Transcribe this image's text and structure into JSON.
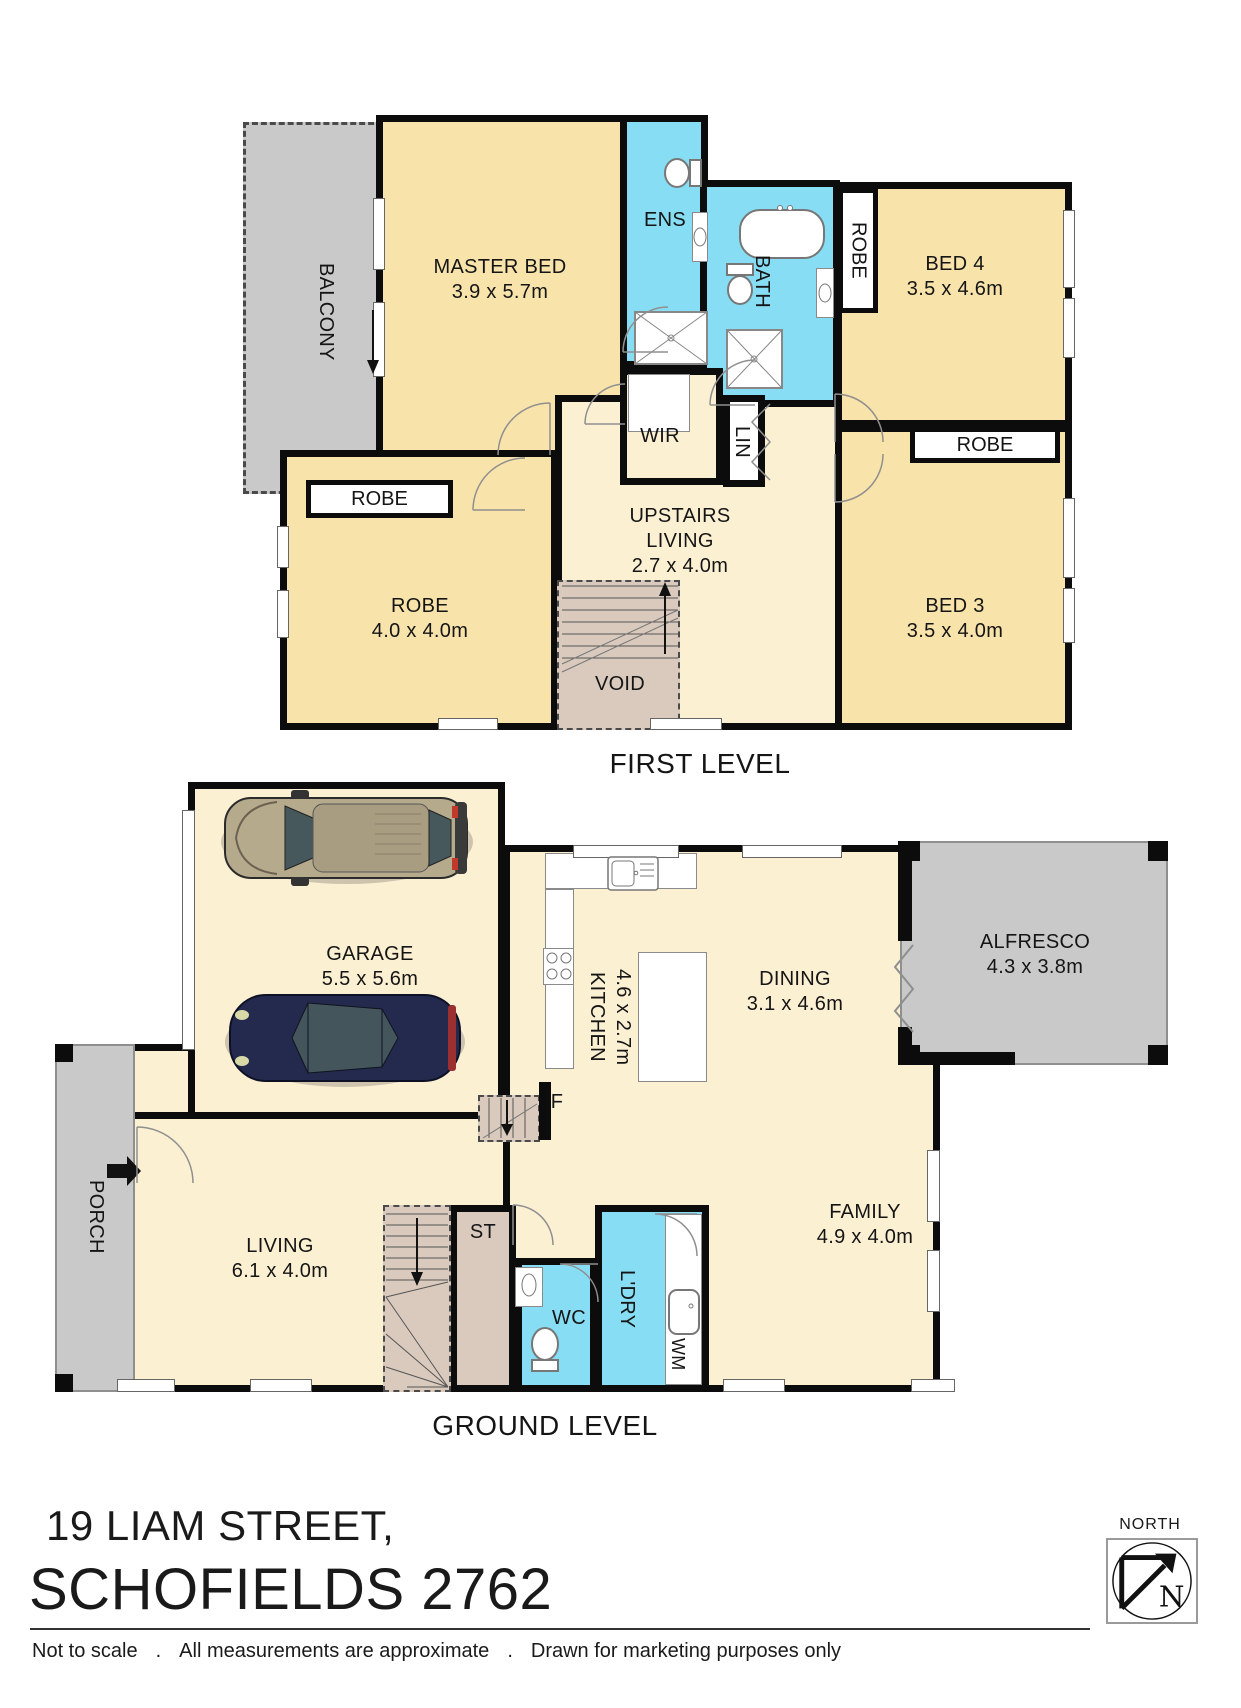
{
  "first_level": {
    "title": "FIRST LEVEL",
    "balcony": "BALCONY",
    "master_bed": {
      "name": "MASTER BED",
      "dims": "3.9 x 5.7m"
    },
    "ens": "ENS",
    "bath": "BATH",
    "robe_tag": "ROBE",
    "bed4": {
      "name": "BED 4",
      "dims": "3.5 x 4.6m"
    },
    "wir": "WIR",
    "lin": "LIN",
    "upstairs_living": {
      "line1": "UPSTAIRS",
      "line2": "LIVING",
      "dims": "2.7 x 4.0m"
    },
    "robe_room": {
      "name": "ROBE",
      "dims": "4.0 x 4.0m"
    },
    "void": "VOID",
    "bed3": {
      "name": "BED 3",
      "dims": "3.5 x 4.0m"
    }
  },
  "ground_level": {
    "title": "GROUND LEVEL",
    "garage": {
      "name": "GARAGE",
      "dims": "5.5 x 5.6m"
    },
    "kitchen": {
      "name": "KITCHEN",
      "dims": "4.6 x 2.7m"
    },
    "dining": {
      "name": "DINING",
      "dims": "3.1 x 4.6m"
    },
    "alfresco": {
      "name": "ALFRESCO",
      "dims": "4.3 x 3.8m"
    },
    "family": {
      "name": "FAMILY",
      "dims": "4.9 x 4.0m"
    },
    "living": {
      "name": "LIVING",
      "dims": "6.1 x 4.0m"
    },
    "porch": "PORCH",
    "storage": "ST",
    "wc": "WC",
    "laundry": "L'DRY",
    "washing_machine": "WM",
    "fridge": "F"
  },
  "footer": {
    "address_line1": "19 LIAM STREET,",
    "address_line2": "SCHOFIELDS 2762",
    "north_label": "NORTH",
    "north_letter": "N",
    "disclaimer_1": "Not to scale",
    "disclaimer_sep": ".",
    "disclaimer_2": "All measurements are approximate",
    "disclaimer_3": "Drawn for marketing purposes only"
  },
  "colors": {
    "room_cream": "#f8e3ab",
    "room_cream_light": "#fcf0d3",
    "wet_area_blue": "#87ddf3",
    "outdoor_gray": "#c9c9c9",
    "stair_tan": "#d9cabd",
    "wall_black": "#0c0c0c"
  }
}
